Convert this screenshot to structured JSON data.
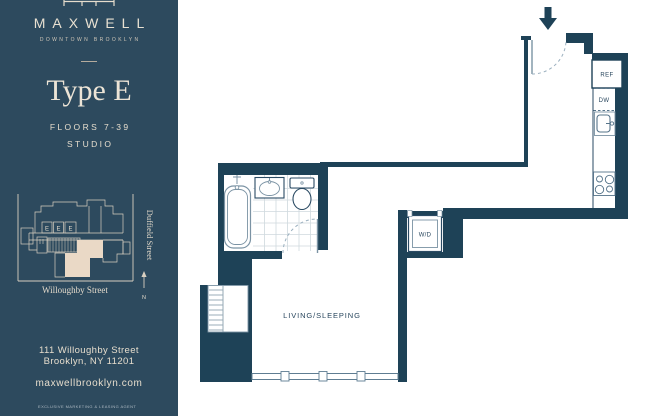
{
  "sidebar": {
    "brand": {
      "name": "MAXWELL",
      "tagline": "DOWNTOWN BROOKLYN"
    },
    "unit": {
      "type": "Type E",
      "floors": "FLOORS 7-39",
      "layout": "STUDIO"
    },
    "keyplan": {
      "street_right": "Duffield Street",
      "street_bottom": "Willoughby Street",
      "north_label": "N",
      "unit_markers": [
        "E",
        "E",
        "E"
      ]
    },
    "address_line1": "111 Willoughby Street",
    "address_line2": "Brooklyn, NY 11201",
    "website": "maxwellbrooklyn.com",
    "footer_note": "EXCLUSIVE MARKETING & LEASING AGENT"
  },
  "floorplan": {
    "labels": {
      "living": "LIVING/SLEEPING",
      "washer_dryer": "W/D",
      "refrigerator": "REF",
      "dishwasher": "DW"
    }
  },
  "colors": {
    "sidebar_background": "#2d4a5e",
    "wall": "#1e4257",
    "cream_text": "#e6ddcd",
    "unit_highlight": "#ead9c6",
    "fixture_line": "#7b93a4",
    "plan_label": "#27455c"
  }
}
